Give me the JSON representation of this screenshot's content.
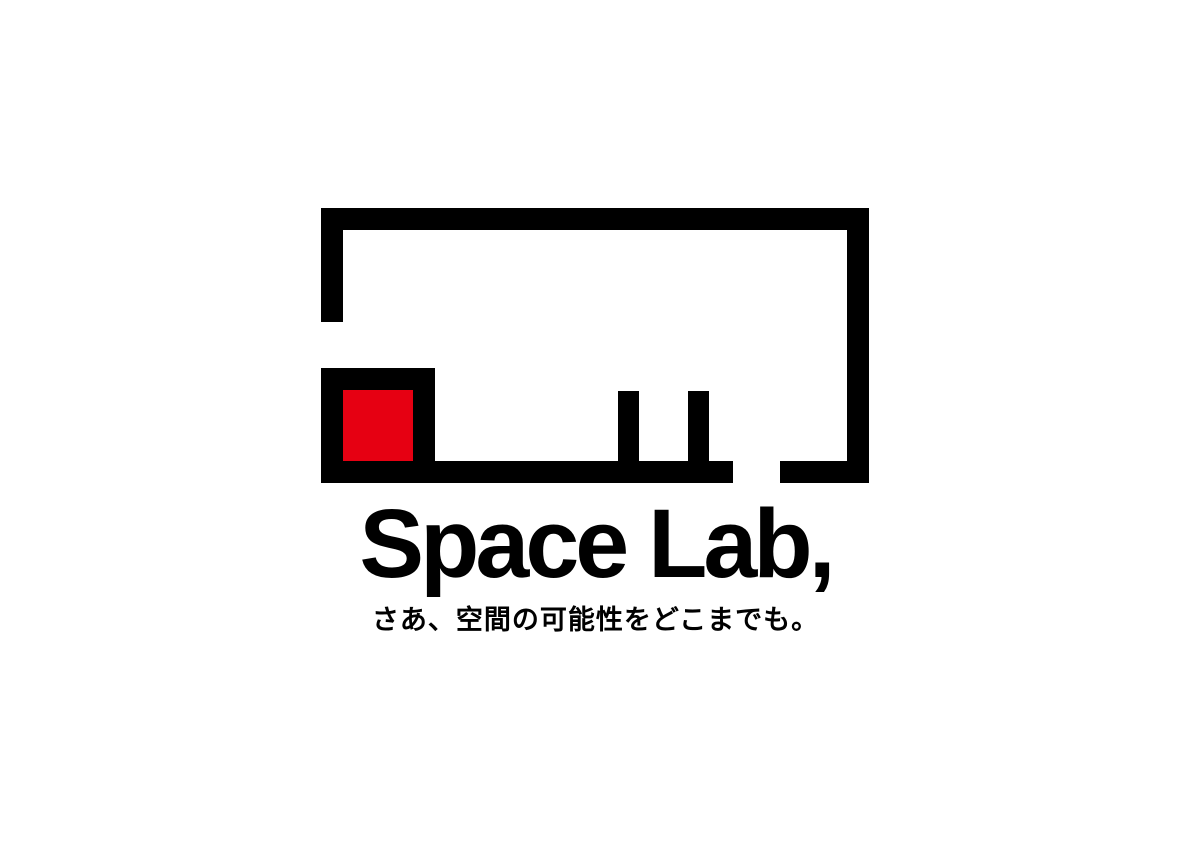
{
  "page": {
    "background_color": "#ffffff"
  },
  "logo": {
    "brand_name": "Space Lab,",
    "tagline": "さあ、空間の可能性をどこまでも。",
    "colors": {
      "mark_black": "#000000",
      "accent_red": "#E60012",
      "text_black": "#000000"
    },
    "mark": {
      "style": "abstract-floor-plan",
      "elements": [
        "outer-top-wall",
        "outer-left-wall-with-gap",
        "outer-right-wall",
        "outer-bottom-wall-with-gap",
        "inner-room-walls",
        "red-accent-square",
        "table-leg-left",
        "table-leg-right"
      ]
    }
  }
}
